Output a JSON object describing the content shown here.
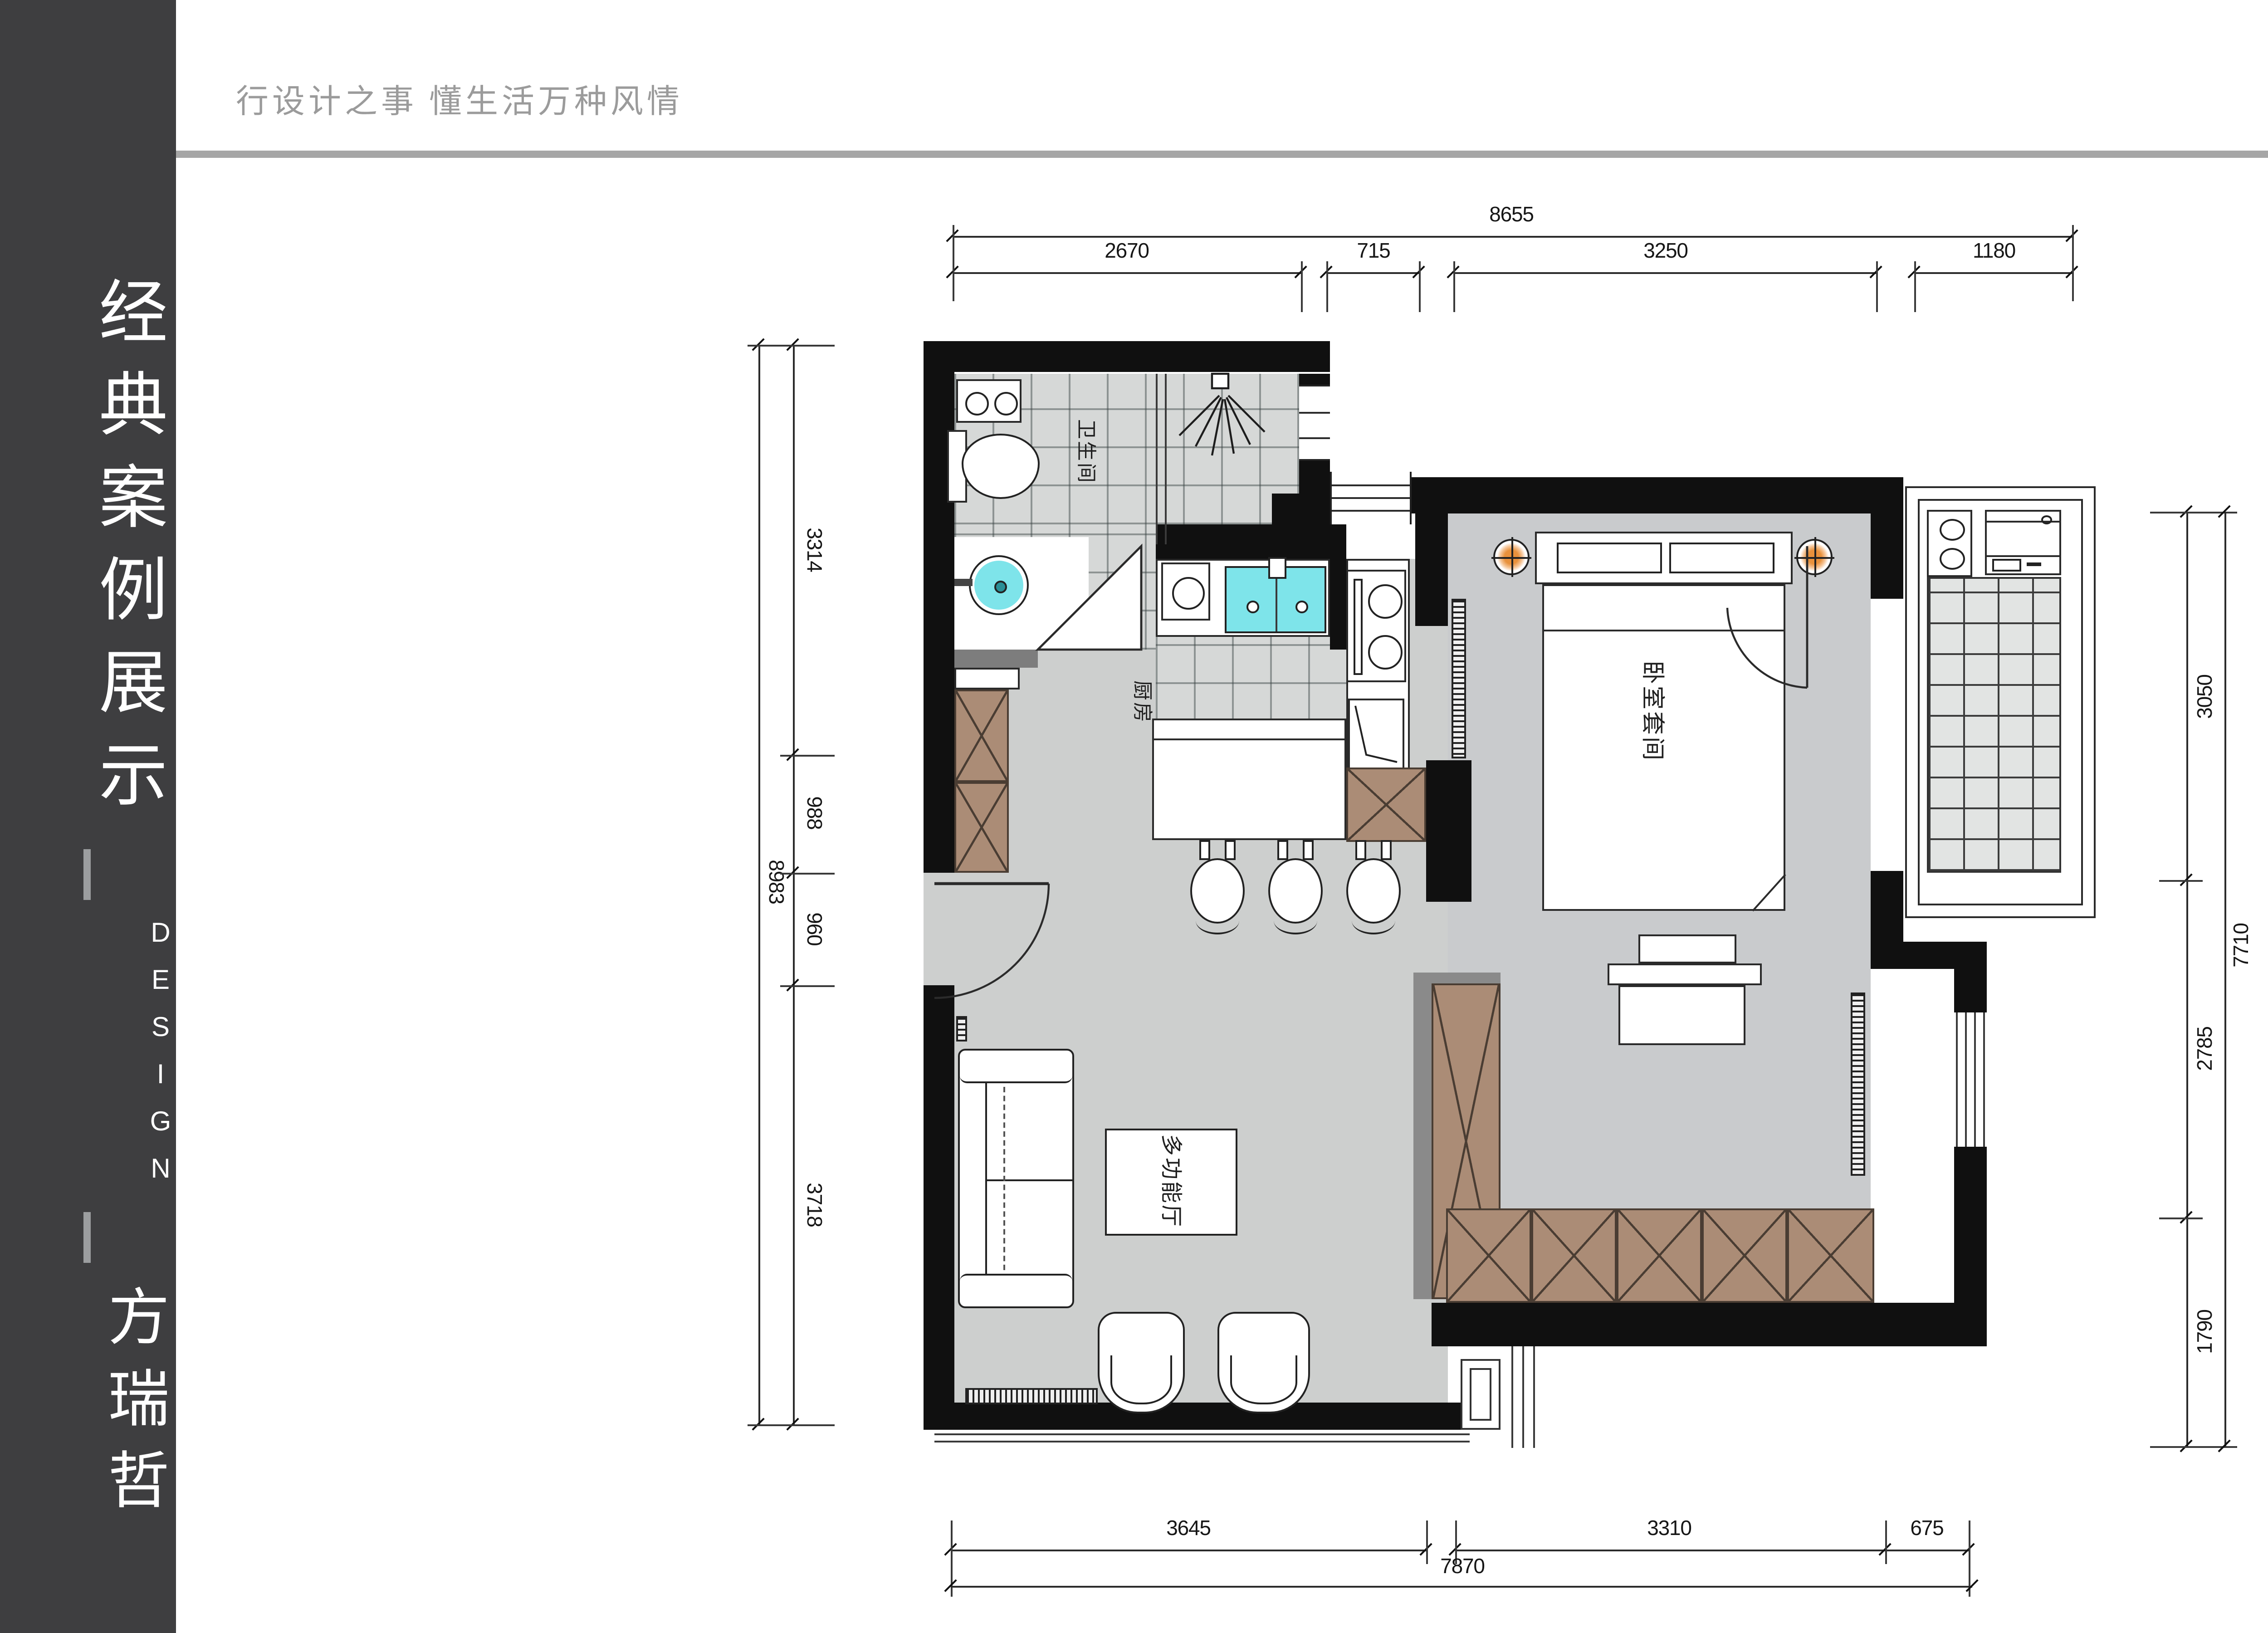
{
  "sidebar": {
    "title": "经典案例展示",
    "design_word": "DESIGN",
    "author": "方瑞哲"
  },
  "header": {
    "slogan": "行设计之事 懂生活万种风情",
    "brand": "【梵高|先生】"
  },
  "plan": {
    "rooms": {
      "bathroom": "卫生间",
      "kitchen": "厨房",
      "bedroom": "卧室套间",
      "hall": "多功能厅"
    },
    "dimensions": {
      "top": {
        "overall": "8655",
        "segments": [
          "2670",
          "715",
          "3250",
          "1180"
        ]
      },
      "bottom": {
        "overall": "7870",
        "segments": [
          "3645",
          "3310",
          "675"
        ]
      },
      "left": {
        "overall": "8983",
        "segments": [
          "3314",
          "988",
          "960",
          "3718"
        ]
      },
      "right": {
        "overall": "7710",
        "segments": [
          "3050",
          "2785",
          "1790"
        ]
      }
    }
  },
  "colors": {
    "sidebar": "#3e3e40",
    "divider": "#a6a6a6",
    "wall": "#101010",
    "floor_gray": "#cdcfce",
    "tile_gray": "#d6d8d7",
    "cabinet_brown": "#ab8c76",
    "fixture_cyan": "#7ee4ea",
    "lamp_orange": "#e8913c"
  }
}
